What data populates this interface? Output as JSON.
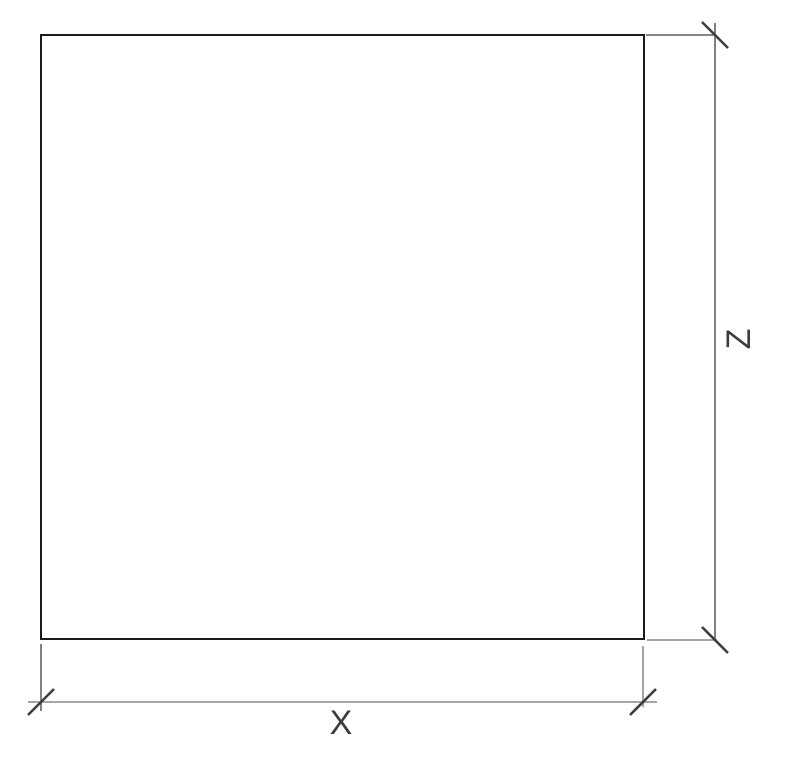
{
  "canvas": {
    "background": "#ffffff"
  },
  "colors": {
    "outline": "#1a1a1a",
    "dimension_dark": "#3d3d3d",
    "dimension_light": "#a6a6a6",
    "label": "#3d3d3d"
  },
  "dimensions": {
    "x": {
      "label": "X"
    },
    "z": {
      "label": "Z"
    }
  }
}
